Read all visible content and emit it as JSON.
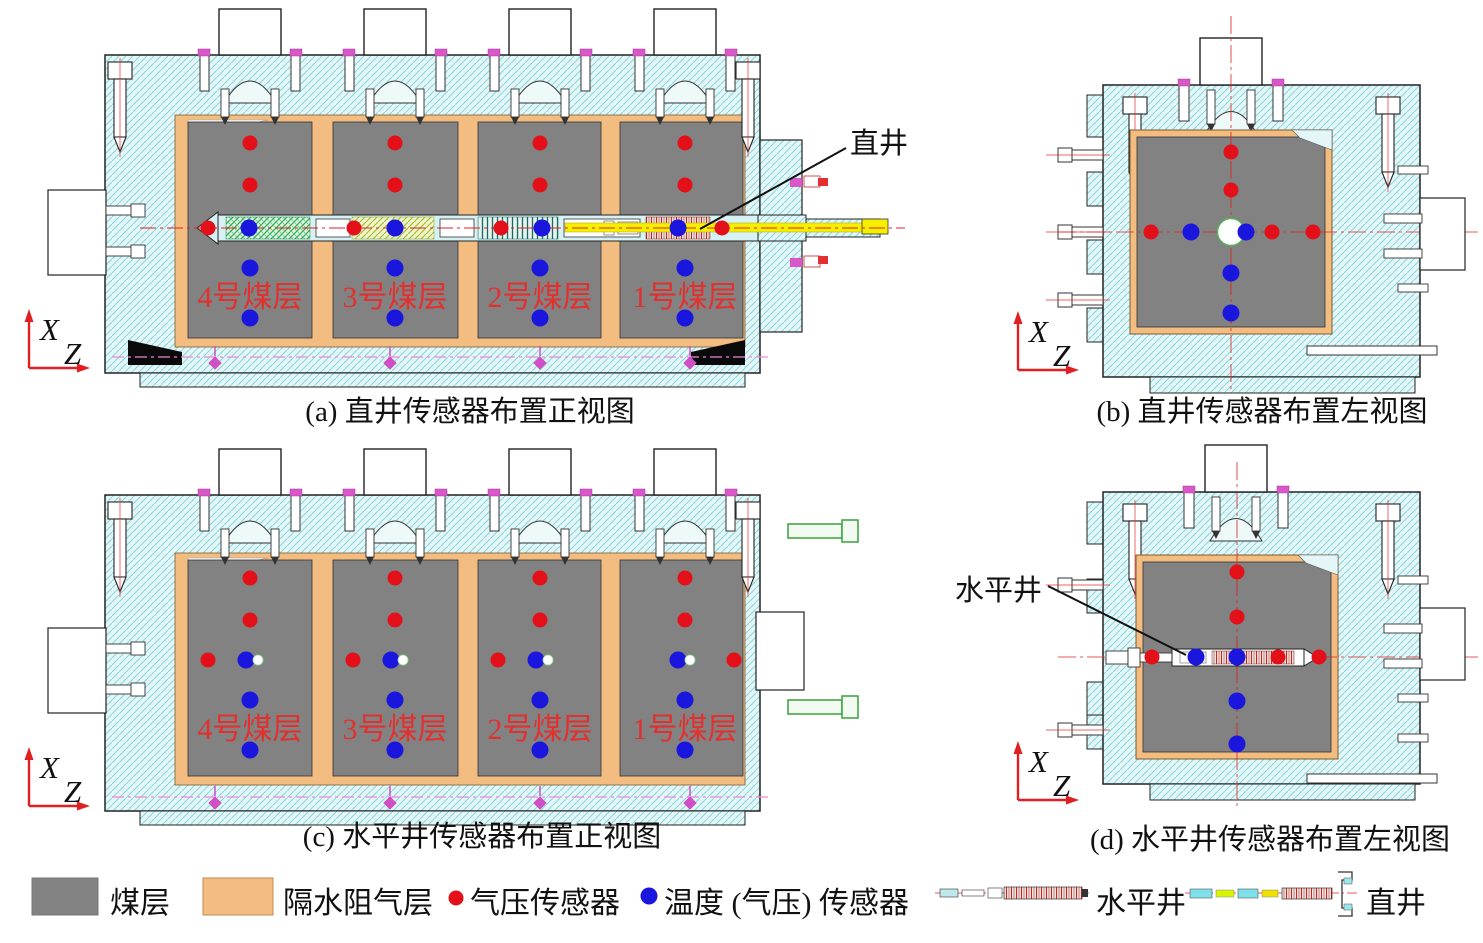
{
  "colors": {
    "red": "#e31019",
    "blue": "#1a16dd",
    "coal": "#828282",
    "aquiclude": "#f3bd81",
    "axis": "#e02020"
  },
  "seam_labels": [
    "4号煤层",
    "3号煤层",
    "2号煤层",
    "1号煤层"
  ],
  "axes": {
    "x": "X",
    "z": "Z"
  },
  "panels": {
    "a": {
      "caption": "(a) 直井传感器布置正视图",
      "well_label": "直井",
      "seam_columns": [
        250,
        395,
        540,
        685
      ],
      "seam_label_y": 307,
      "sensors": [
        {
          "x": 250,
          "y": 143,
          "t": "red"
        },
        {
          "x": 250,
          "y": 185,
          "t": "red"
        },
        {
          "x": 395,
          "y": 143,
          "t": "red"
        },
        {
          "x": 395,
          "y": 185,
          "t": "red"
        },
        {
          "x": 540,
          "y": 143,
          "t": "red"
        },
        {
          "x": 540,
          "y": 185,
          "t": "red"
        },
        {
          "x": 685,
          "y": 143,
          "t": "red"
        },
        {
          "x": 685,
          "y": 185,
          "t": "red"
        },
        {
          "x": 208,
          "y": 228,
          "t": "red"
        },
        {
          "x": 249,
          "y": 228,
          "t": "blue"
        },
        {
          "x": 354,
          "y": 228,
          "t": "red"
        },
        {
          "x": 395,
          "y": 228,
          "t": "blue"
        },
        {
          "x": 501,
          "y": 228,
          "t": "red"
        },
        {
          "x": 542,
          "y": 228,
          "t": "blue"
        },
        {
          "x": 678,
          "y": 228,
          "t": "blue"
        },
        {
          "x": 722,
          "y": 228,
          "t": "red"
        },
        {
          "x": 250,
          "y": 268,
          "t": "blue"
        },
        {
          "x": 250,
          "y": 318,
          "t": "blue"
        },
        {
          "x": 395,
          "y": 268,
          "t": "blue"
        },
        {
          "x": 395,
          "y": 318,
          "t": "blue"
        },
        {
          "x": 540,
          "y": 268,
          "t": "blue"
        },
        {
          "x": 540,
          "y": 318,
          "t": "blue"
        },
        {
          "x": 685,
          "y": 268,
          "t": "blue"
        },
        {
          "x": 685,
          "y": 318,
          "t": "blue"
        }
      ]
    },
    "b": {
      "caption": "(b) 直井传感器布置左视图",
      "sensors": [
        {
          "x": 1231,
          "y": 152,
          "t": "red"
        },
        {
          "x": 1231,
          "y": 190,
          "t": "red"
        },
        {
          "x": 1231,
          "y": 273,
          "t": "blue"
        },
        {
          "x": 1231,
          "y": 313,
          "t": "blue"
        },
        {
          "x": 1151,
          "y": 232,
          "t": "red"
        },
        {
          "x": 1191,
          "y": 232,
          "t": "blue"
        },
        {
          "x": 1246,
          "y": 232,
          "t": "blue"
        },
        {
          "x": 1272,
          "y": 232,
          "t": "red"
        },
        {
          "x": 1313,
          "y": 232,
          "t": "red"
        }
      ]
    },
    "c": {
      "caption": "(c) 水平井传感器布置正视图",
      "seam_columns": [
        250,
        395,
        540,
        685
      ],
      "seam_label_y": 739,
      "sensors": [
        {
          "x": 250,
          "y": 578,
          "t": "red"
        },
        {
          "x": 250,
          "y": 620,
          "t": "red"
        },
        {
          "x": 395,
          "y": 578,
          "t": "red"
        },
        {
          "x": 395,
          "y": 620,
          "t": "red"
        },
        {
          "x": 540,
          "y": 578,
          "t": "red"
        },
        {
          "x": 540,
          "y": 620,
          "t": "red"
        },
        {
          "x": 685,
          "y": 578,
          "t": "red"
        },
        {
          "x": 685,
          "y": 620,
          "t": "red"
        },
        {
          "x": 208,
          "y": 660,
          "t": "red"
        },
        {
          "x": 246,
          "y": 660,
          "t": "blue"
        },
        {
          "x": 258,
          "y": 660,
          "t": "bore"
        },
        {
          "x": 353,
          "y": 660,
          "t": "red"
        },
        {
          "x": 391,
          "y": 660,
          "t": "blue"
        },
        {
          "x": 403,
          "y": 660,
          "t": "bore"
        },
        {
          "x": 498,
          "y": 660,
          "t": "red"
        },
        {
          "x": 536,
          "y": 660,
          "t": "blue"
        },
        {
          "x": 548,
          "y": 660,
          "t": "bore"
        },
        {
          "x": 678,
          "y": 660,
          "t": "blue"
        },
        {
          "x": 690,
          "y": 660,
          "t": "bore"
        },
        {
          "x": 734,
          "y": 660,
          "t": "red"
        },
        {
          "x": 250,
          "y": 700,
          "t": "blue"
        },
        {
          "x": 250,
          "y": 750,
          "t": "blue"
        },
        {
          "x": 395,
          "y": 700,
          "t": "blue"
        },
        {
          "x": 395,
          "y": 750,
          "t": "blue"
        },
        {
          "x": 540,
          "y": 700,
          "t": "blue"
        },
        {
          "x": 540,
          "y": 750,
          "t": "blue"
        },
        {
          "x": 685,
          "y": 700,
          "t": "blue"
        },
        {
          "x": 685,
          "y": 750,
          "t": "blue"
        }
      ]
    },
    "d": {
      "caption": "(d) 水平井传感器布置左视图",
      "well_label": "水平井",
      "sensors": [
        {
          "x": 1237,
          "y": 572,
          "t": "red"
        },
        {
          "x": 1237,
          "y": 617,
          "t": "red"
        },
        {
          "x": 1237,
          "y": 701,
          "t": "blue"
        },
        {
          "x": 1237,
          "y": 744,
          "t": "blue"
        },
        {
          "x": 1152,
          "y": 657,
          "t": "red"
        },
        {
          "x": 1196,
          "y": 657,
          "t": "blue"
        },
        {
          "x": 1237,
          "y": 657,
          "t": "blue"
        },
        {
          "x": 1278,
          "y": 657,
          "t": "red"
        },
        {
          "x": 1319,
          "y": 657,
          "t": "red"
        }
      ]
    }
  },
  "legend": {
    "items": [
      {
        "key": "coal",
        "label": "煤层"
      },
      {
        "key": "aquiclude",
        "label": "隔水阻气层"
      },
      {
        "key": "pressure-sensor",
        "label": "气压传感器"
      },
      {
        "key": "temperature-sensor",
        "label": "温度 (气压) 传感器"
      },
      {
        "key": "horizontal-well",
        "label": "水平井"
      },
      {
        "key": "vertical-well",
        "label": "直井"
      }
    ]
  }
}
